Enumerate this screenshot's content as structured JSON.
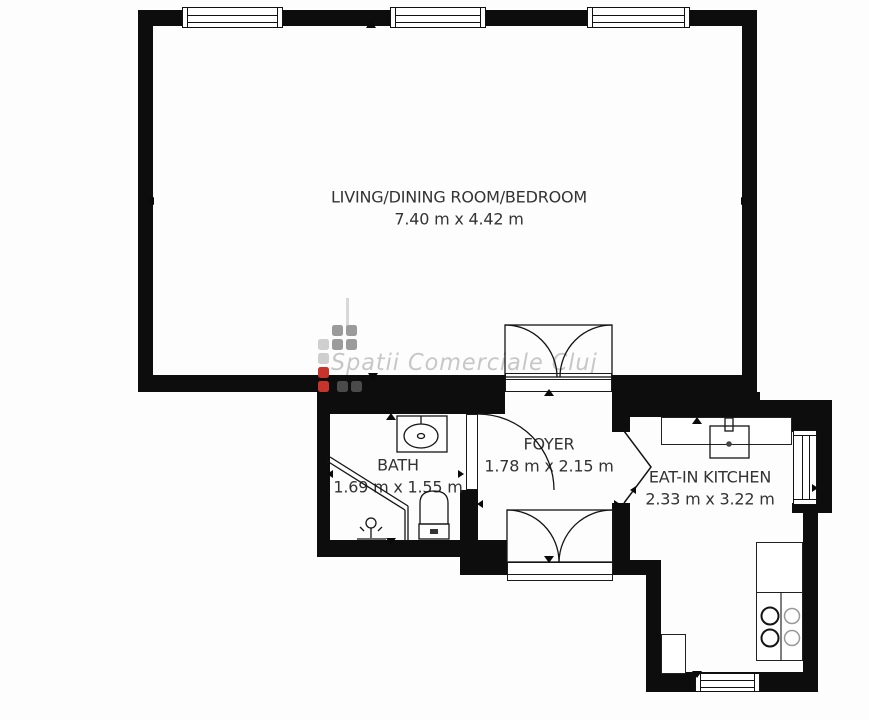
{
  "plan_title": "apartment floor plan",
  "watermark": {
    "text": "Spatii Comerciale Cluj"
  },
  "rooms": [
    {
      "name": "LIVING/DINING ROOM/BEDROOM",
      "dims": "7.40 m x 4.42 m"
    },
    {
      "name": "BATH",
      "dims": "1.69 m x 1.55 m"
    },
    {
      "name": "FOYER",
      "dims": "1.78 m x 2.15 m"
    },
    {
      "name": "EAT-IN KITCHEN",
      "dims": "2.33 m x 3.22 m"
    }
  ],
  "icons": [
    "window-icon",
    "double-door-swing-icon",
    "door-swing-icon",
    "opening-chevron-icon",
    "bath-sink-icon",
    "toilet-icon",
    "shower-enclosure-icon",
    "faucet-icon",
    "kitchen-sink-icon",
    "stove-burners-icon",
    "fridge-icon",
    "dimension-arrow-icon"
  ],
  "colors": {
    "wall": "#0d0d0d",
    "label_text": "#333333",
    "watermark_text": "#c7c7c7",
    "logo_red": "#c6342c",
    "logo_gray": "#9b9b9b",
    "logo_dark": "#4a4a4a",
    "logo_light": "#cfcfcf"
  }
}
